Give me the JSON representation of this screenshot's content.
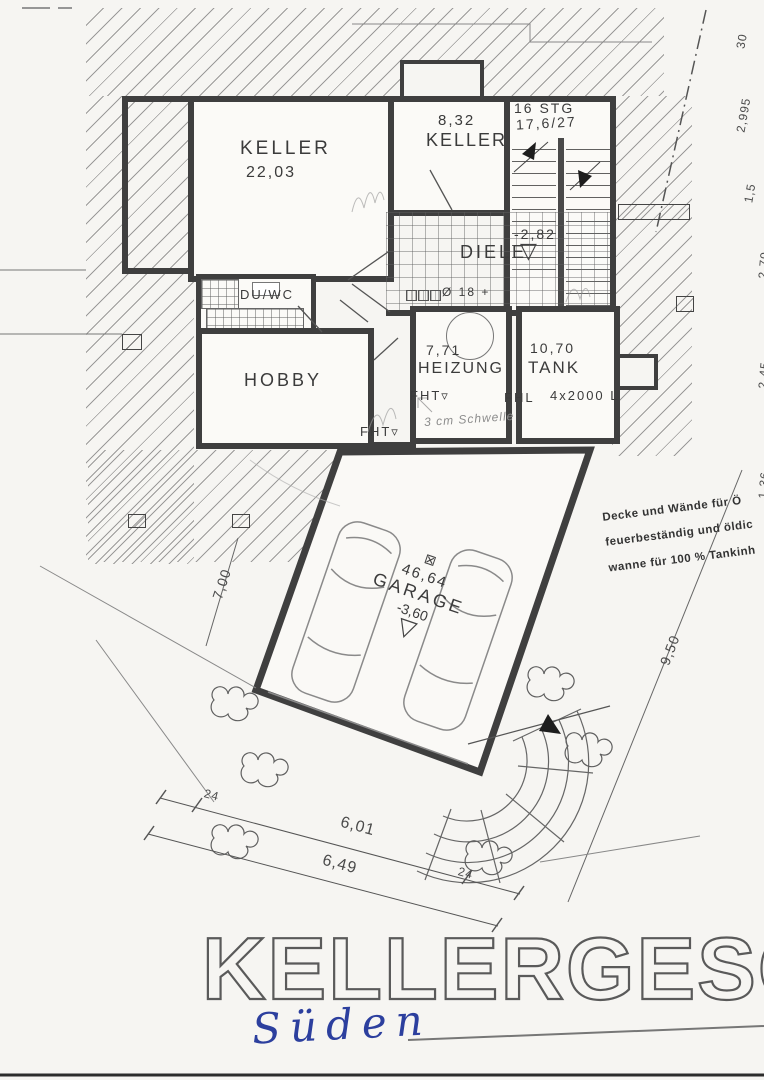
{
  "page": {
    "bg": "#f6f5f2",
    "ink": "#3e3e3e",
    "pen_blue": "#2c3f9e"
  },
  "title": {
    "text": "KELLERGESCHOSS",
    "handwritten": "Süden"
  },
  "rooms": {
    "keller1": {
      "name": "KELLER",
      "area": "22,03"
    },
    "keller2": {
      "name": "KELLER",
      "area": "8,32"
    },
    "diele": {
      "name": "DIELE",
      "level": "-2,82"
    },
    "duwc": {
      "name": "DU/WC"
    },
    "hobby": {
      "name": "HOBBY"
    },
    "heizung": {
      "name": "HEIZUNG",
      "area": "7,71"
    },
    "tank": {
      "name": "TANK",
      "area": "10,70",
      "capacity": "4x2000 L"
    },
    "garage": {
      "name": "GARAGE",
      "area": "46,64",
      "level": "-3,60"
    }
  },
  "stairs": {
    "count": "16 STG",
    "riser_tread": "17,6/27"
  },
  "annotations": {
    "fht": "FHT",
    "fhl": "FHL",
    "duct": "Ø 18 +",
    "threshold": "3 cm Schwelle"
  },
  "note_block": {
    "line1": "Decke und Wände für Ö",
    "line2": "feuerbeständig und öldic",
    "line3": "wanne für 100 % Tankinh"
  },
  "dimensions": {
    "d700": "7,00",
    "d950": "9,50",
    "d601": "6,01",
    "d649": "6,49",
    "d24": "24",
    "edge": {
      "e1": "30",
      "e2": "2,995",
      "e3": "1,5",
      "e4": "2,70",
      "e5": "2,45",
      "e6": "1,36"
    }
  },
  "icons": {
    "height_marker": "▽",
    "down_arrow": "▿",
    "gully": "⊠"
  }
}
